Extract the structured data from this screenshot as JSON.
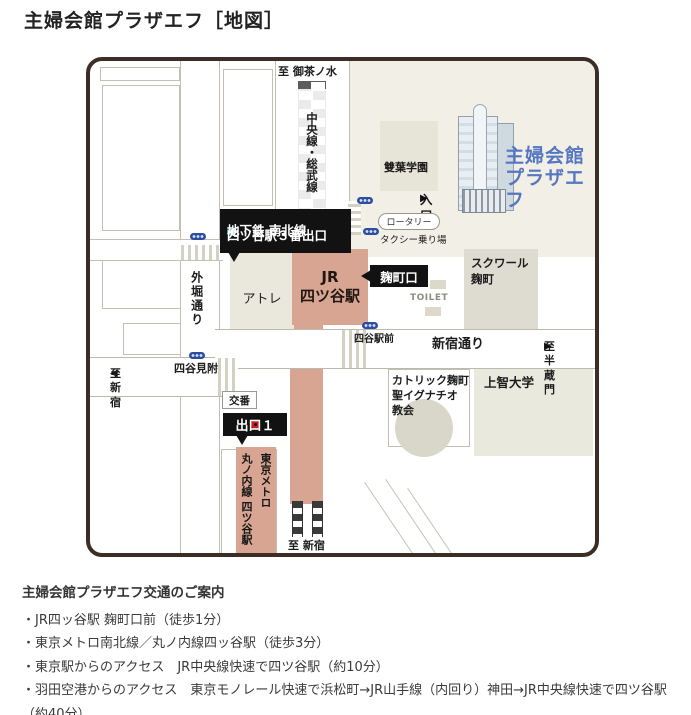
{
  "page": {
    "title": "主婦会館プラザエフ［地図］"
  },
  "icons": {
    "arrow_right": "▶",
    "arrow_left": "◀"
  },
  "colors": {
    "map_border": "#3c2e26",
    "station_pink": "#d9a593",
    "plaza_name_blue": "#5577c2",
    "subway_ring_teal": "#27a393",
    "exit_ring_red": "#cf1c1c",
    "signal_blue": "#2e4d9e",
    "area_beige": "#f2efe6"
  },
  "map": {
    "labels": {
      "to_ochanomizu": "至 御茶ノ水",
      "chuo_sobu_line": "中央線・総武線",
      "subway_exit_line1": "地下鉄 南北線",
      "subway_exit_line2": "四ツ谷駅３番出口",
      "sotobori_dori": "外堀通り",
      "atre": "アトレ",
      "jr_yotsuya_station": "JR\n四ツ谷駅",
      "kojimachi_exit": "麹町口",
      "rotary": "ロータリー",
      "taxi_stand": "タクシー乗り場",
      "entrance": "入口",
      "futaba_gakuen": "雙葉学園",
      "plaza_ef_name": "主婦会館\nプラザエフ",
      "square_kojimachi": "スクワール\n麹町",
      "toilet": "TOILET",
      "shinjuku_dori": "新宿通り",
      "to_hanzomon": "至 半蔵門",
      "yotsuya_ekimae": "四谷駅前",
      "to_shinjuku_west": "至 新宿",
      "yotsuya_mitsuke": "四谷見附",
      "koban": "交番",
      "exit1": "出口１",
      "tokyo_metro_station": "東京メトロ\n丸ノ内線 四ツ谷駅",
      "to_shinjuku_south": "至 新宿",
      "catholic_church": "カトリック麹町\n聖イグナチオ\n教会",
      "sophia_university": "上智大学"
    }
  },
  "access": {
    "heading": "主婦会館プラザエフ交通のご案内",
    "items": [
      "・JR四ッ谷駅 麹町口前（徒歩1分）",
      "・東京メトロ南北線／丸ノ内線四ッ谷駅（徒歩3分）",
      "・東京駅からのアクセス　JR中央線快速で四ツ谷駅（約10分）",
      "・羽田空港からのアクセス　東京モノレール快速で浜松町→JR山手線（内回り）神田→JR中央線快速で四ツ谷駅（約40分）"
    ]
  }
}
